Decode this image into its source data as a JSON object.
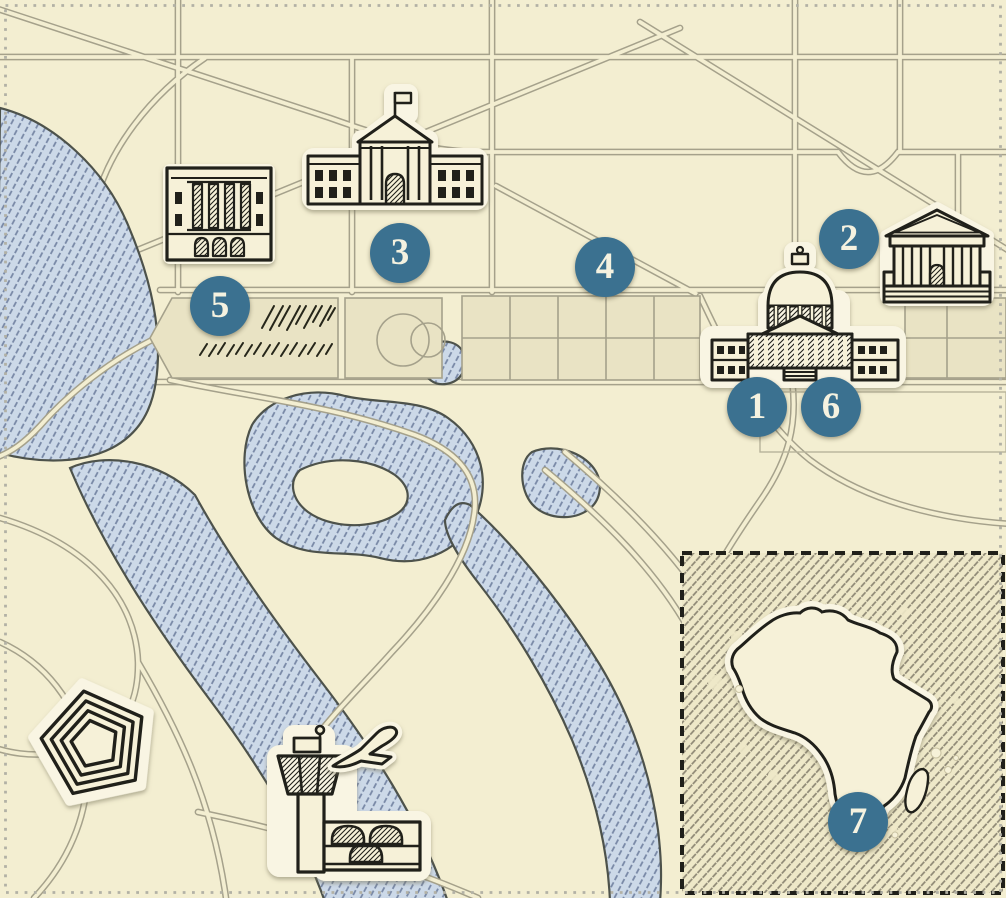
{
  "map": {
    "kind": "hand-drawn illustrated map of the National Mall area, Washington DC, with an Africa inset",
    "visible_text_note": "the only rendered text is the numerals on the seven circular location markers"
  },
  "markers": [
    {
      "label": "1"
    },
    {
      "label": "2"
    },
    {
      "label": "3"
    },
    {
      "label": "4"
    },
    {
      "label": "5"
    },
    {
      "label": "6"
    },
    {
      "label": "7"
    }
  ],
  "icons": [
    "us-capitol-icon",
    "supreme-court-icon",
    "white-house-icon",
    "classical-federal-building-icon",
    "pentagon-icon",
    "airport-control-tower-icon",
    "airplane-icon",
    "africa-continent-icon",
    "ellipse-park-icon",
    "tree-scribble-icon"
  ],
  "colors": {
    "marker_fill": "#3b7190",
    "marker_text": "#f5f2e0",
    "background": "#f3eed1",
    "mall_panel": "#e9e3c4",
    "water_fill": "#ccd9e8",
    "water_hatch": "#7787a5",
    "water_outline": "#4d524b",
    "road_casing": "#a5a18b",
    "ink": "#20201a",
    "sticker_halo": "#f9f5e3",
    "inset_background": "#eee8c8",
    "inset_hatch": "#8d8774",
    "page_border_dots": "#b2b1a5"
  }
}
